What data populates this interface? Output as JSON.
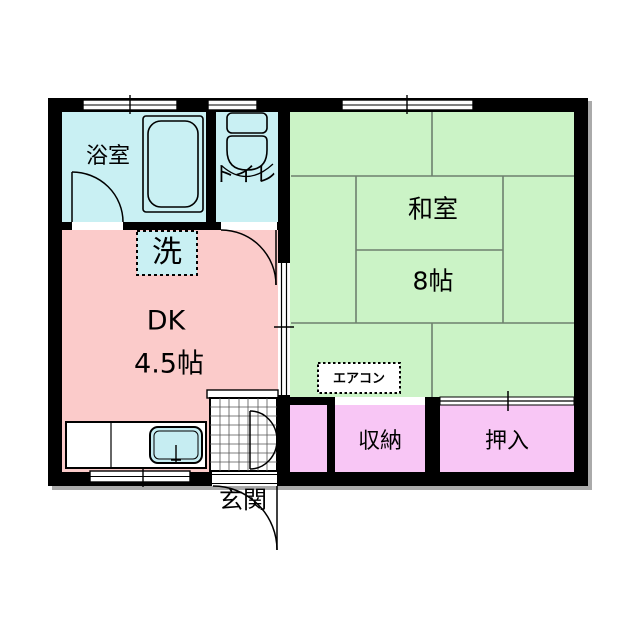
{
  "plan": {
    "title": "1DK apartment floor plan",
    "rooms": {
      "bathroom": {
        "label": "浴室"
      },
      "toilet": {
        "label": "トイレ"
      },
      "dk": {
        "label": "DK",
        "size": "4.5帖"
      },
      "washitsu": {
        "label": "和室",
        "size": "8帖"
      },
      "storage": {
        "label": "収納"
      },
      "closet": {
        "label": "押入"
      },
      "entrance": {
        "label": "玄関"
      }
    },
    "fixtures": {
      "washing_machine": {
        "label": "洗"
      },
      "air_conditioner": {
        "label": "エアコン"
      }
    },
    "colors": {
      "wet_area": "#c9f0f3",
      "dk": "#fbcbca",
      "washitsu": "#cbf3c6",
      "storage": "#f8c6f5",
      "wash_box": "#c9f0f3",
      "aircon_box": "#ffffff",
      "sink": "#c6edf2",
      "tile": "#ffffff",
      "wall": "#000000",
      "tatami_line": "#6e806e",
      "shadow": "#aaaaaa"
    }
  }
}
